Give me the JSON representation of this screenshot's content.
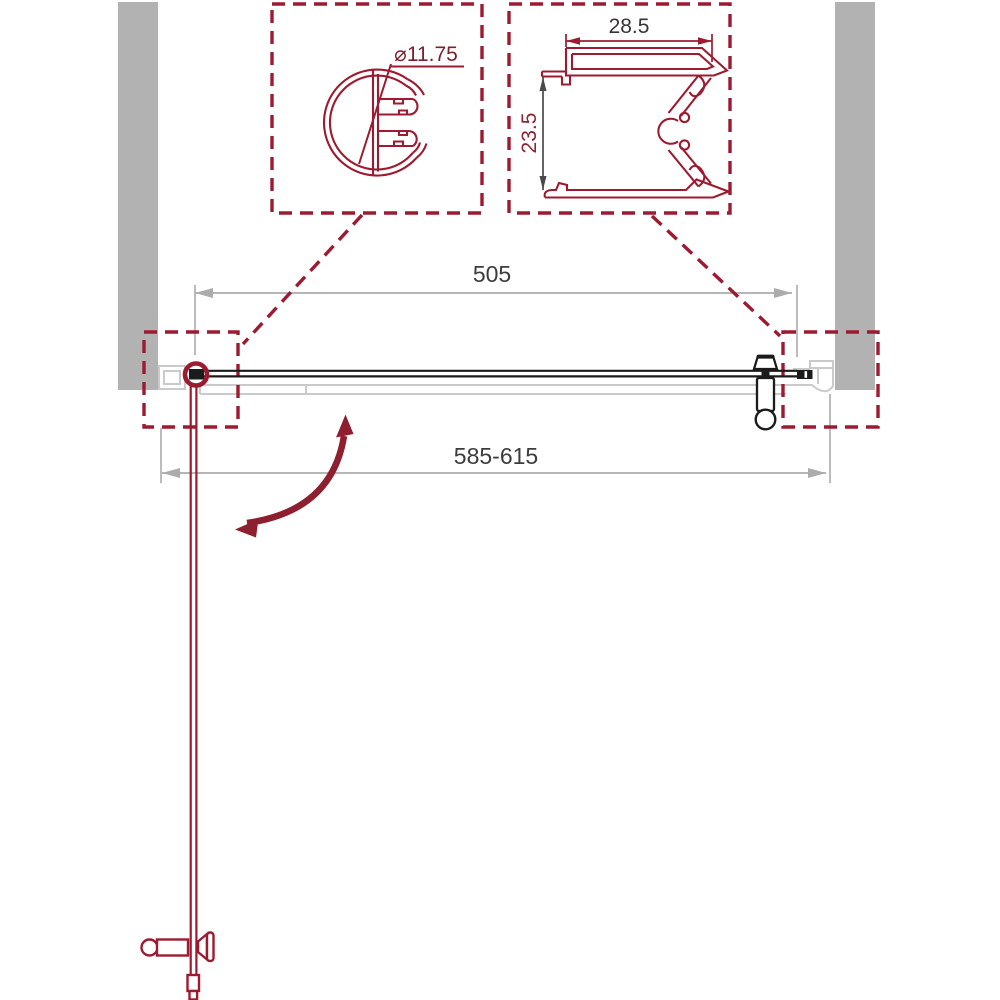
{
  "drawing": {
    "type": "shower-door-installation-plan",
    "labels": {
      "hinge_profile_diameter": "⌀11.75",
      "wall_profile_width": "28.5",
      "wall_profile_depth": "23.5",
      "glass_width": "505",
      "adjustment_range": "585-615"
    },
    "colors": {
      "accent_red": "#9c1b30",
      "swing_arrow_red": "#8d1f2f",
      "wall_gray": "#b2b2b2",
      "ghost_gray": "#cacaca",
      "dimension_gray": "#acacac",
      "ink_black": "#1b1b1b",
      "text_dark": "#3c3c3c"
    }
  }
}
